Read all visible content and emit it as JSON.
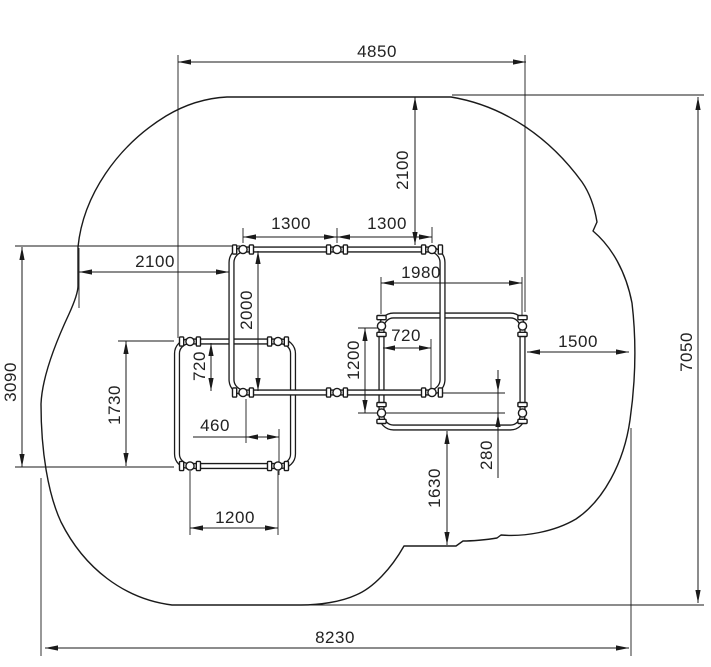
{
  "drawing": {
    "description": "Technical plan drawing of play equipment frames with safety-area outline and dimensions",
    "units_hint": "mm",
    "colors": {
      "line": "#1a1a1a",
      "text": "#222222",
      "background": "#ffffff"
    },
    "dims": {
      "top_width": "4850",
      "top_frame_offset": "2100",
      "top_frame_bay_left": "1300",
      "top_frame_bay_right": "1300",
      "left_clearance": "2100",
      "right_frame_width": "1980",
      "top_frame_height": "2000",
      "left_overlap_gap": "720",
      "right_overlap_gap": "720",
      "right_frame_height": "1200",
      "left_frame_width": "1200",
      "left_frame_height": "1730",
      "left_combined_height": "3090",
      "post_offset": "460",
      "edge_offset": "280",
      "bottom_clearance": "1630",
      "right_clearance": "1500",
      "overall_depth": "7050",
      "overall_width": "8230"
    }
  }
}
